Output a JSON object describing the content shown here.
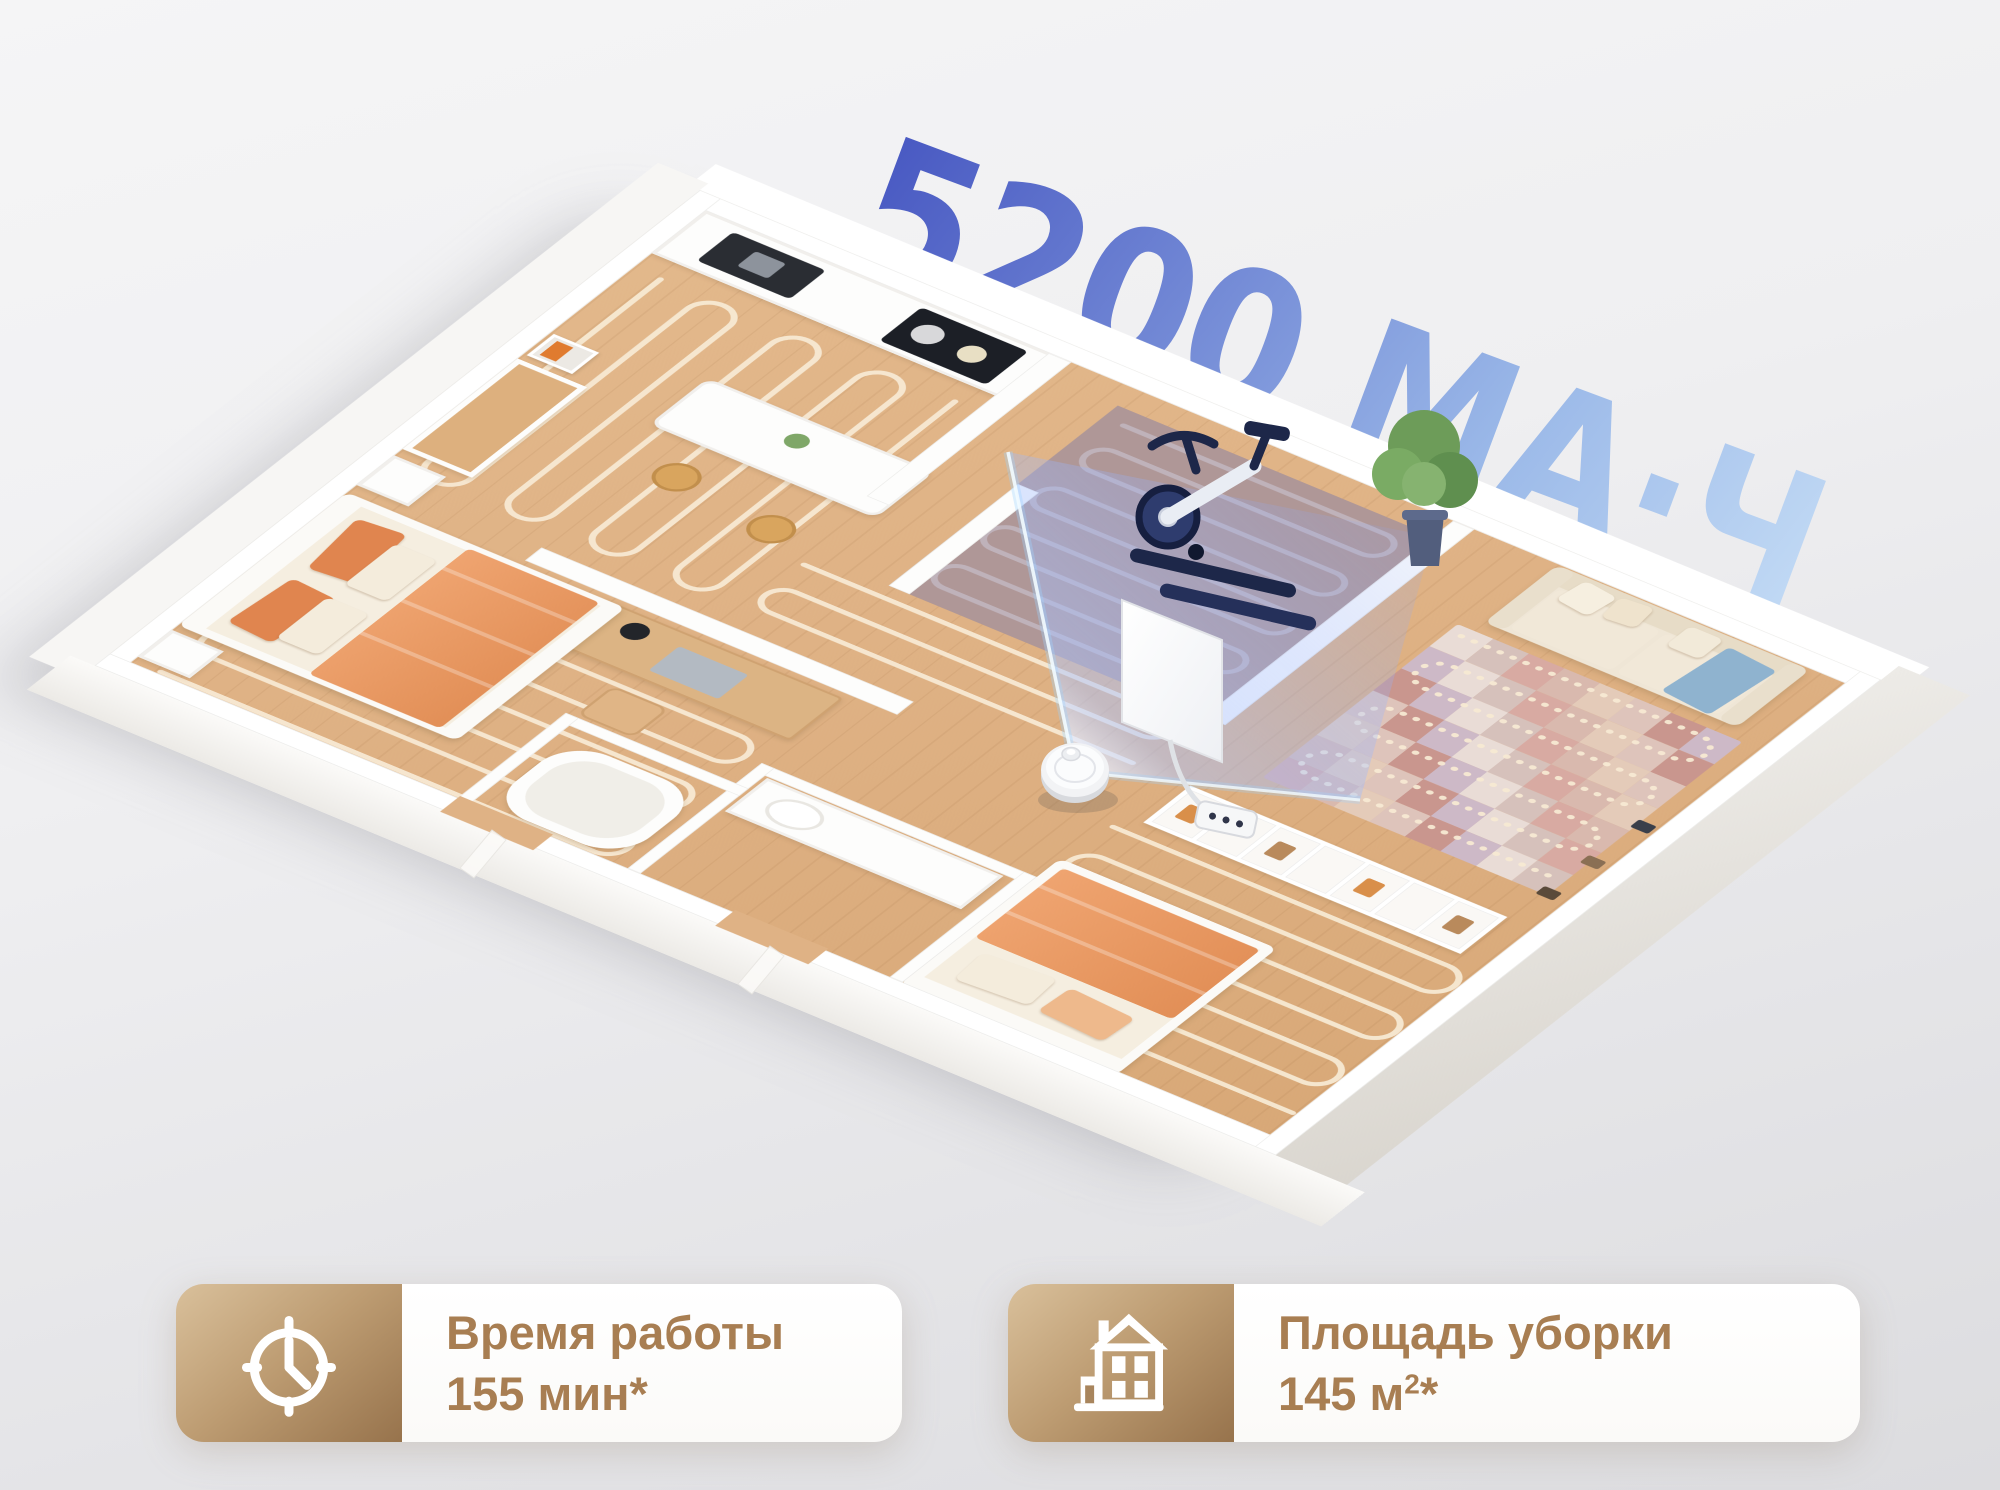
{
  "headline": {
    "text": "5200 МА·Ч",
    "gradient_start": "#4656c1",
    "gradient_end": "#c3dbf5"
  },
  "stats": [
    {
      "icon": "clock-icon",
      "label": "Время работы",
      "value": "155 мин",
      "footnote": "*"
    },
    {
      "icon": "house-icon",
      "label": "Площадь уборки",
      "value": "145 м",
      "superscript": "2",
      "footnote": "*"
    }
  ],
  "scene": {
    "background_top": "#f5f5f6",
    "background_bottom": "#dcdcdf",
    "floor_color": "#dfb285",
    "wall_color": "#ffffff",
    "cleaning_path_color": "#f7e9d3",
    "beam_color": "#8fa8ff",
    "fitness_room_tint": "rgba(104,124,224,0.30)",
    "bedding_color": "#e8965f",
    "sofa_color": "#efe6d6",
    "badge_gold_light": "#d9c09b",
    "badge_gold_dark": "#97734c",
    "stat_text_color": "#a87e52",
    "rug_palette": [
      "#e9dcd6",
      "#dec4bb",
      "#d8aaa2",
      "#cdb9c7",
      "#e4cbb9",
      "#d6c1bb",
      "#c9968e",
      "#d9b9ae"
    ],
    "shelf_item_palette": [
      "#d98f4a",
      "#7a5c3e",
      "#b98a5c",
      "#88642f"
    ],
    "objects": [
      "robot-vacuum",
      "laser-beam",
      "exercise-bike",
      "tv-screen",
      "power-strip",
      "kitchen-counter",
      "sink",
      "cooktop",
      "dining-island",
      "stool",
      "desk",
      "office-chair",
      "dresser",
      "art-frame",
      "nightstand",
      "bed",
      "bathtub",
      "toilet",
      "vanity",
      "clothes-rack",
      "sofa",
      "patchwork-rug",
      "shelving-unit",
      "potted-plant"
    ]
  }
}
